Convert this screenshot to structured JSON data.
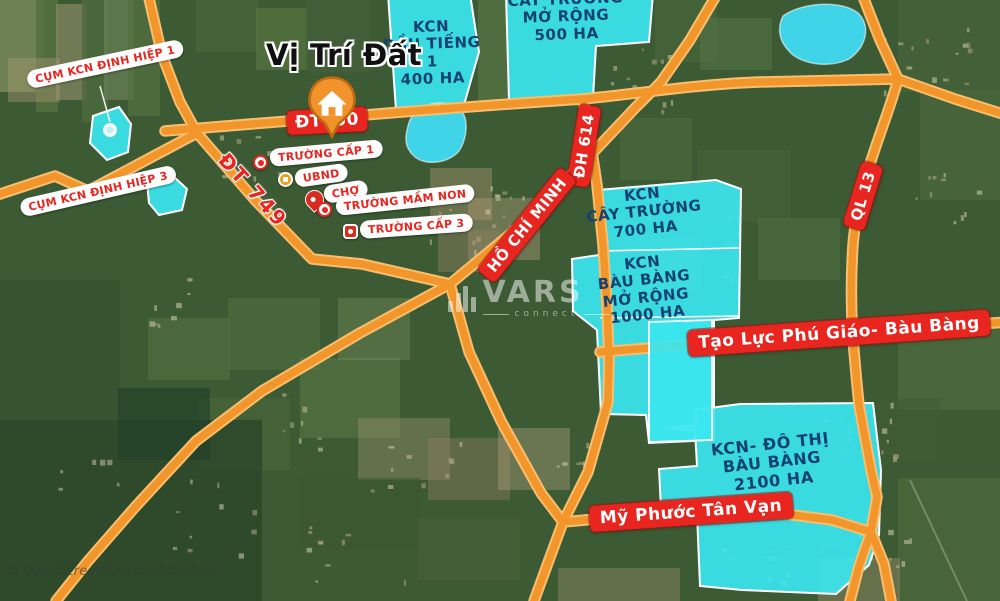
{
  "map": {
    "title": "Vị Trí Đất",
    "watermark": {
      "brand": "VARS",
      "sub": "connect"
    },
    "attribution": "© OpenStreetMap contributors"
  },
  "road_labels": {
    "dt750": "ĐT750",
    "dt749": "ĐT 749",
    "dh614": "ĐH 614",
    "ho_chi_minh": "HỒ CHÍ MINH",
    "ql13": "QL 13",
    "tao_luc": "Tạo Lực Phú Giáo- Bàu Bàng",
    "my_phuoc": "Mỹ Phước Tân Vạn"
  },
  "cluster_labels": {
    "dinh_hiep_1": "CỤM KCN ĐỊNH HIỆP 1",
    "dinh_hiep_3": "CỤM KCN ĐỊNH HIỆP 3"
  },
  "zones": {
    "dau_tieng": {
      "lines": [
        "KCN",
        "DẦU TIẾNG",
        "1",
        "400 HA"
      ]
    },
    "cay_truong_mo_rong": {
      "lines": [
        "CÂY TRƯỜNG",
        "MỞ RỘNG",
        "500 HA"
      ]
    },
    "cay_truong": {
      "lines": [
        "KCN",
        "CÂY TRƯỜNG",
        "700 HA"
      ]
    },
    "bau_bang_mo_rong": {
      "lines": [
        "KCN",
        "BÀU BÀNG",
        "MỞ RỘNG",
        "1000 HA"
      ]
    },
    "do_thi_bau_bang": {
      "lines": [
        "KCN- ĐÔ THỊ",
        "BÀU BÀNG",
        "2100 HA"
      ]
    }
  },
  "pois": [
    {
      "label": "TRƯỜNG CẤP 1"
    },
    {
      "label": "UBND"
    },
    {
      "label": "CHỢ"
    },
    {
      "label": "TRƯỜNG MẦM NON"
    },
    {
      "label": "TRƯỜNG CẤP 3"
    }
  ],
  "colors": {
    "road": "#F2952B",
    "road_casing": "#F7BF6E",
    "zone_fill": "#3BE6EF",
    "zone_text": "#154270",
    "badge_red": "#E8251F",
    "poi_text": "#E8251F",
    "pin_orange": "#F2922B"
  }
}
